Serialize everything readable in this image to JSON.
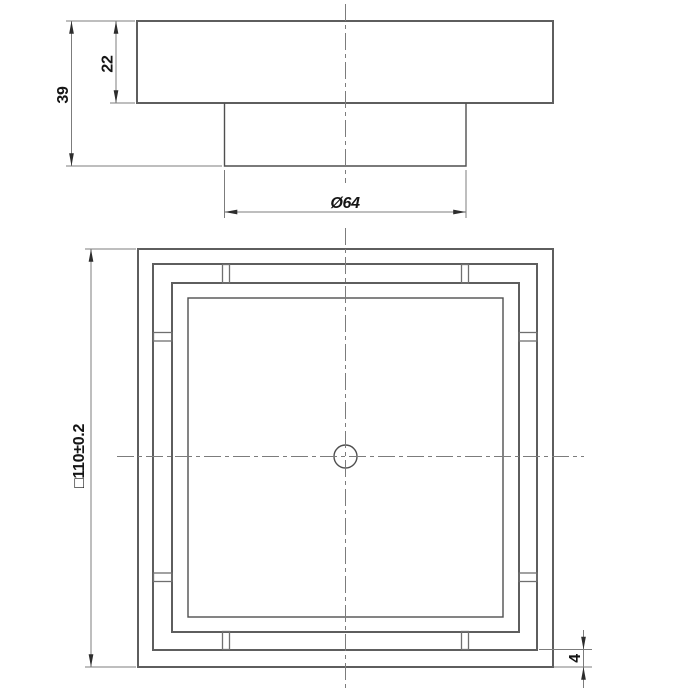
{
  "page": {
    "background": "#ffffff"
  },
  "drawing": {
    "dimensions": {
      "total_height": "39",
      "flange_height": "22",
      "outlet_diameter": "Ø64",
      "outer_square": "□110±0.2",
      "frame_inset": "4"
    },
    "colors": {
      "object_line": "#5e5e5e",
      "thin_line": "#7c7c7c",
      "arrow": "#2d2d2d",
      "text": "#151515",
      "background": "#ffffff"
    }
  }
}
